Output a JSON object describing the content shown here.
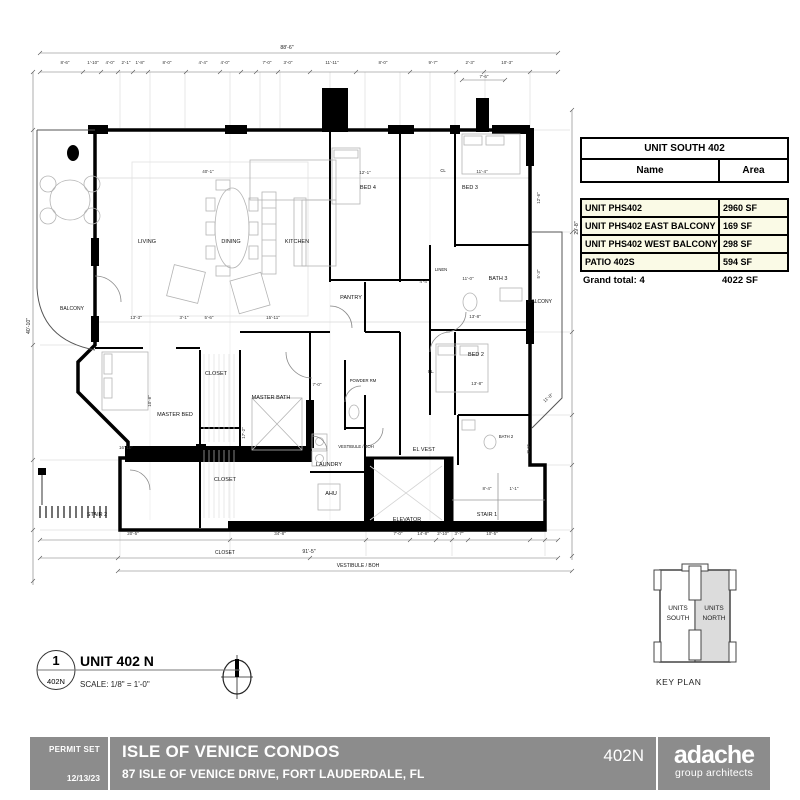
{
  "colors": {
    "title_bar": "#8c8c8c",
    "table_row_bg": "#fafae6",
    "keyplan_shade": "#dcdcdc",
    "wall": "#000000"
  },
  "area_table": {
    "title": "UNIT SOUTH 402",
    "col_name": "Name",
    "col_area": "Area",
    "rows": [
      {
        "name": "UNIT PHS402",
        "area": "2960 SF"
      },
      {
        "name": "UNIT PHS402 EAST BALCONY",
        "area": "169 SF"
      },
      {
        "name": "UNIT PHS402 WEST BALCONY",
        "area": "298 SF"
      },
      {
        "name": "PATIO 402S",
        "area": "594 SF"
      }
    ],
    "total_label": "Grand total: 4",
    "total_area": "4022 SF"
  },
  "keyplan": {
    "label": "KEY PLAN",
    "units_word": "UNITS",
    "south_word": "SOUTH",
    "north_word": "NORTH"
  },
  "drawing_title": {
    "number": "1",
    "sheet_ref": "402N",
    "title": "UNIT 402 N",
    "scale_label": "SCALE:  1/8\" = 1'-0\""
  },
  "titleblock": {
    "permit_set": "PERMIT SET",
    "date": "12/13/23",
    "project": "ISLE OF VENICE CONDOS",
    "address": "87 ISLE OF VENICE DRIVE, FORT LAUDERDALE, FL",
    "sheet": "402N",
    "firm_name": "adache",
    "firm_sub": "group architects"
  },
  "plan": {
    "rooms": {
      "living": "LIVING",
      "dining": "DINING",
      "kitchen": "KITCHEN",
      "bed4": "BED 4",
      "bed3": "BED 3",
      "bed2": "BED 2",
      "bath3": "BATH 3",
      "bath2": "BATH 2",
      "master_bed": "MASTER BED",
      "master_bath": "MASTER BATH",
      "closet_a": "CLOSET",
      "closet_b": "CLOSET",
      "closet_c": "CLOSET",
      "pantry": "PANTRY",
      "powder": "POWDER RM",
      "laundry": "LAUNDRY",
      "ahu": "AHU",
      "vest": "VESTIBULE / BOH",
      "vest2": "VESTIBULE / BOH",
      "el_vest": "EL VEST",
      "elevator": "ELEVATOR",
      "stair1": "STAIR 1",
      "stair2": "STAIR 2",
      "balcony_w": "BALCONY",
      "balcony_e": "BALCONY",
      "linen": "LINEN",
      "cl": "CL.",
      "cl2": "CL"
    },
    "dims": {
      "overall_top": "88'-6\"",
      "seg": [
        "8'-6\"",
        "1'-10\"",
        "4'-0\"",
        "2'-1\"",
        "1'-8\"",
        "8'-0\"",
        "4'-4\"",
        "4'-0\"",
        "7'-0\"",
        "3'-0\"",
        "11'-11\"",
        "8'-0\"",
        "9'-7\"",
        "2'-3\"",
        "10'-3\""
      ],
      "sub": "7'-6\"",
      "overall_left": "40'-10\"",
      "overall_right": "29'-8\"",
      "bottom_overall": "91'-5\"",
      "b20_5": "20'-5\"",
      "b34_8": "34'-8\"",
      "b7_0": "7'-0\"",
      "b14_8": "14'-8\"",
      "b2_10": "2'-10\"",
      "b3_7": "3'-7\"",
      "b10_5": "10'-5\"",
      "d40_1": "40'-1\"",
      "d12_1": "12'-1\"",
      "d11_4": "11'-4\"",
      "d13_3": "13'-3\"",
      "d3_1": "3'-1\"",
      "d5_6": "5'-6\"",
      "d15_11": "15'-11\"",
      "d13_8a": "13'-8\"",
      "d13_8b": "13'-8\"",
      "d11_0": "11'-0\"",
      "d16_10": "16'-10\"",
      "d10_8": "10'-8\"",
      "d17_2": "17'-2\"",
      "d8_4": "8'-4\"",
      "d1_1": "1'-1\"",
      "d8_6": "8'-6\"",
      "d12_6": "12'-6\"",
      "d5_3": "5'-3\"",
      "d11_8": "11'-8\"",
      "d7_0b": "7'-0\"",
      "d4_4": "4'-4\""
    }
  }
}
